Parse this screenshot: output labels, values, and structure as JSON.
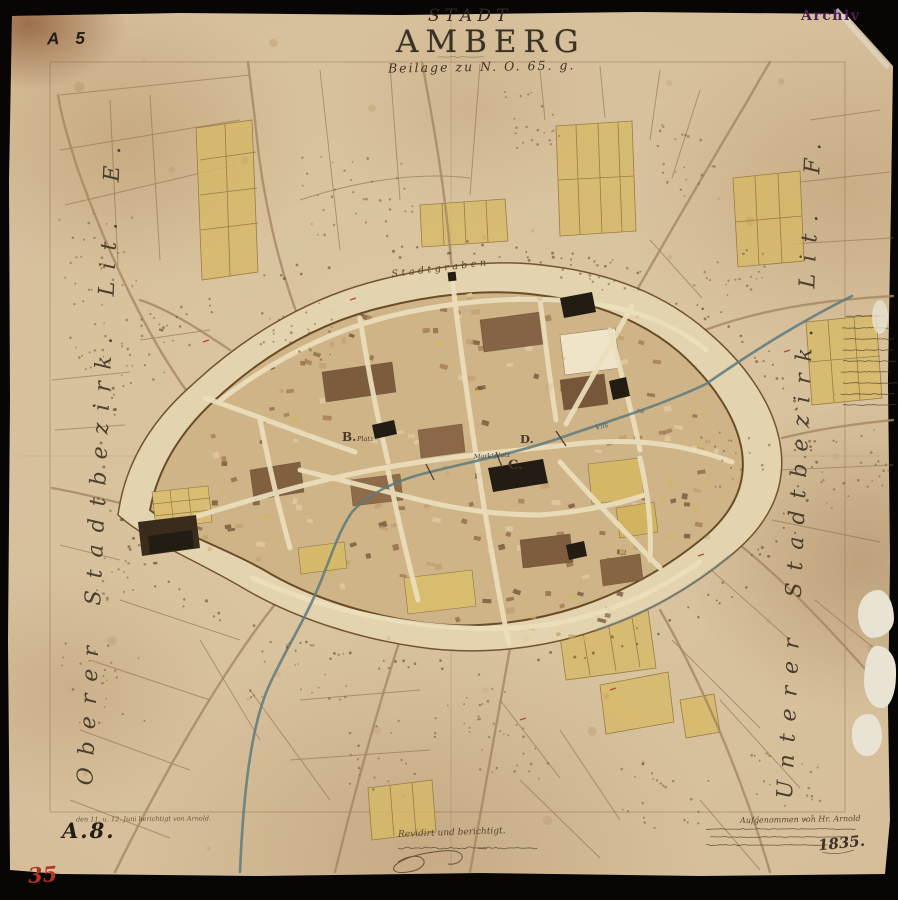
{
  "artifact": {
    "archive_stamp": "Archiv",
    "sheet_mark_top_left": "A 5",
    "sheet_mark_bottom_left": "A.8.",
    "inventory_number_red": "35"
  },
  "title": {
    "kicker": "STADT",
    "main": "AMBERG",
    "reference_line": "Beilage zu N. O. 65. g."
  },
  "margin_labels": {
    "left_district": "Oberer Stadtbezirk. Lit. E.",
    "right_district": "Unterer Stadtbezirk. Lit. F."
  },
  "map_labels": {
    "moat": "Stadtgraben",
    "market_square": "Marktplatz",
    "square_b_letter": "B.",
    "square_b_word": "Platz",
    "block_c": "C.",
    "block_d": "D.",
    "river": "Vils"
  },
  "annotations": {
    "revision_note": "den 11. u. 12. Juni berichtigt von Arnold.",
    "certification_line": "Revidirt und berichtigt.",
    "surveyor_note": "Aufgenommen von Hr. Arnold",
    "year": "1835."
  },
  "colors": {
    "paper": "#d3bc96",
    "ink": "#6b4f33",
    "parcel_yellow": "#d6b967",
    "river_teal": "#5d7a7e",
    "stamp_purple": "#4d2157",
    "red_accent": "#b23524",
    "backdrop_black": "#070605"
  }
}
